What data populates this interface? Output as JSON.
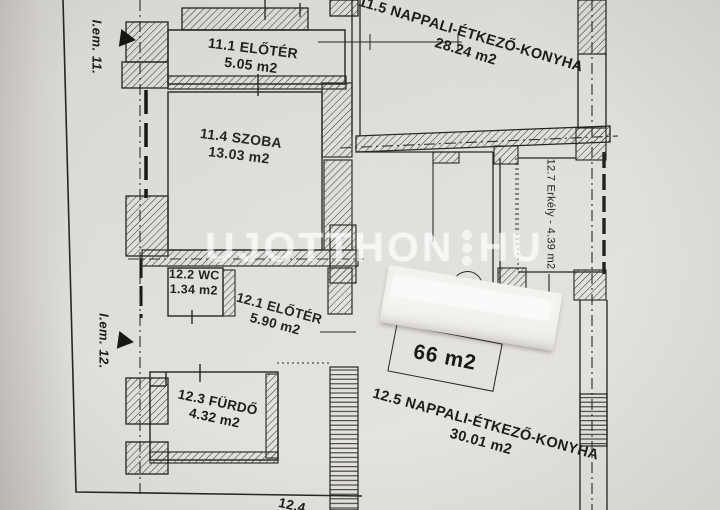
{
  "photo": {
    "floor_markers": [
      {
        "label": "I.em. 11."
      },
      {
        "label": "I.em. 12."
      }
    ],
    "rooms": [
      {
        "name": "11.1 ELŐTÉR",
        "area": "5.05 m2"
      },
      {
        "name": "11.4 SZOBA",
        "area": "13.03 m2"
      },
      {
        "name": "11.5 NAPPALI-ÉTKEZŐ-KONYHA",
        "area": "28.24 m2"
      },
      {
        "name": "12.1 ELŐTÉR",
        "area": "5.90 m2"
      },
      {
        "name": "12.2 WC",
        "area": "1.34 m2"
      },
      {
        "name": "12.3 FÜRDŐ",
        "area": "4.32 m2"
      },
      {
        "name": "12.5 NAPPALI-ÉTKEZŐ-KONYHA",
        "area": "30.01 m2"
      },
      {
        "name": "12.7 Erkély - 4.39 m2"
      },
      {
        "name": "12.4"
      }
    ],
    "unit_number": "12",
    "area_stamp": "66 m2",
    "watermark": {
      "left": "UJOTTHON",
      "right": "HU"
    }
  }
}
